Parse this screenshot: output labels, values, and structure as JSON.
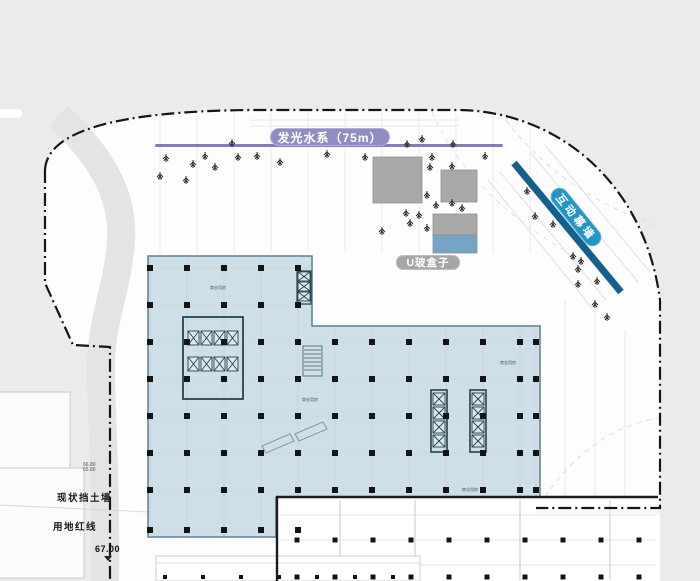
{
  "labels": {
    "water_feature": "发光水系（75m）",
    "u_glass_box": "U玻盒子",
    "interactive_wall": "互动幕墙",
    "retaining_wall": "现状挡土墙",
    "red_line": "用地红线",
    "level_main": "67.00",
    "level_small_1": "66.80",
    "level_small_2": "65.80"
  },
  "colors": {
    "bg-outer": "#ebebeb",
    "bg-inner": "#fdfdfd",
    "pill-purple": "#908dc3",
    "water-line": "#817eba",
    "pill-gray": "#a6a6a6",
    "box-gray": "#a9a9a9",
    "glass-blue": "#74a4c6",
    "stripe-blue": "#15608f",
    "wall-pill-blue": "#2395c5",
    "building-fill": "#cfdfe8",
    "building-line": "#5d7f92",
    "column-black": "#141414",
    "boundary-black": "#151515"
  },
  "plan": {
    "room_labels": [
      {
        "x": 218,
        "y": 288,
        "text": "商业用房"
      },
      {
        "x": 310,
        "y": 400,
        "text": "商业用房"
      },
      {
        "x": 508,
        "y": 363,
        "text": "商业用房"
      },
      {
        "x": 470,
        "y": 490,
        "text": "商业用房"
      }
    ],
    "column_groups": [
      {
        "name": "left-block",
        "size": 6,
        "xs": [
          150,
          187,
          224,
          261,
          298
        ],
        "ys": [
          268,
          305,
          342,
          379,
          416,
          453,
          490,
          530
        ],
        "grid": {
          "x1": 148,
          "y1": 256,
          "x2": 312,
          "y2": 537
        }
      },
      {
        "name": "right-wing",
        "size": 6,
        "xs": [
          335,
          372,
          409,
          446,
          483,
          520,
          536
        ],
        "ys": [
          342,
          379,
          416,
          453,
          490
        ],
        "grid": {
          "x1": 312,
          "y1": 326,
          "x2": 540,
          "y2": 497
        }
      },
      {
        "name": "lower-section",
        "size": 5,
        "xs": [
          297,
          335,
          373,
          411,
          449,
          487,
          525,
          563,
          601,
          639
        ],
        "ys": [
          540,
          577
        ],
        "grid": null
      },
      {
        "name": "lower-left-fragment",
        "size": 4,
        "xs": [
          165,
          203,
          241,
          279,
          317,
          355,
          393
        ],
        "ys": [
          577
        ],
        "grid": null
      }
    ],
    "trees": [
      [
        166,
        154
      ],
      [
        193,
        160
      ],
      [
        205,
        152
      ],
      [
        215,
        163
      ],
      [
        160,
        172
      ],
      [
        186,
        176
      ],
      [
        232,
        139
      ],
      [
        238,
        153
      ],
      [
        257,
        152
      ],
      [
        280,
        158
      ],
      [
        327,
        150
      ],
      [
        365,
        153
      ],
      [
        407,
        140
      ],
      [
        422,
        135
      ],
      [
        432,
        153
      ],
      [
        453,
        140
      ],
      [
        430,
        163
      ],
      [
        452,
        162
      ],
      [
        485,
        152
      ],
      [
        427,
        191
      ],
      [
        436,
        201
      ],
      [
        452,
        199
      ],
      [
        462,
        204
      ],
      [
        406,
        209
      ],
      [
        419,
        211
      ],
      [
        410,
        219
      ],
      [
        427,
        224
      ],
      [
        382,
        227
      ],
      [
        527,
        187
      ],
      [
        535,
        212
      ],
      [
        553,
        220
      ],
      [
        573,
        252
      ],
      [
        581,
        257
      ],
      [
        578,
        265
      ],
      [
        597,
        277
      ],
      [
        578,
        280
      ],
      [
        595,
        300
      ],
      [
        607,
        313
      ]
    ]
  }
}
